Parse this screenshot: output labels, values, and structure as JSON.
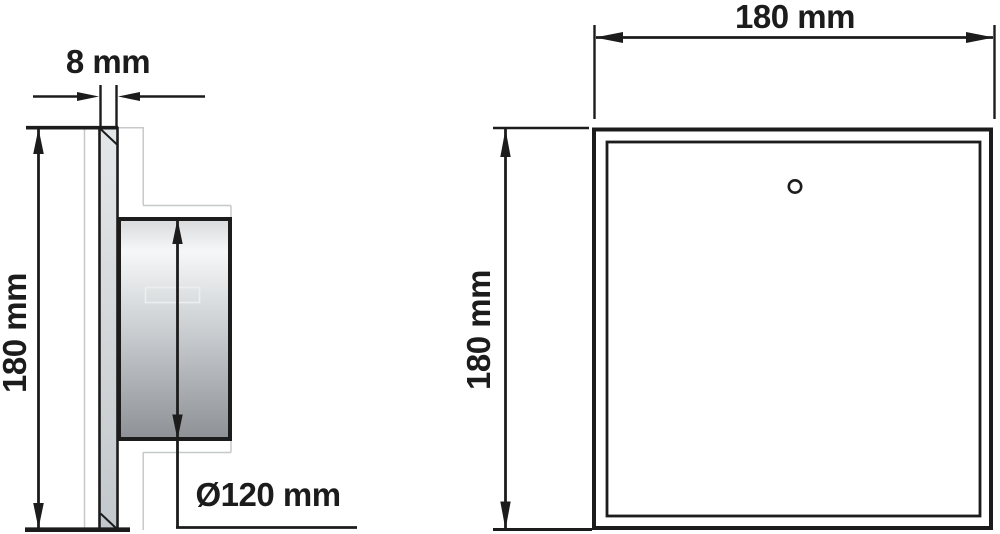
{
  "labels": {
    "side_view": {
      "thickness": "8 mm",
      "height": "180 mm",
      "diameter": "Ø120 mm"
    },
    "front_view": {
      "width": "180 mm",
      "height": "180 mm"
    }
  },
  "colors": {
    "line": "#1c1c1c",
    "faint_line": "#c6c9cb",
    "background": "#ffffff",
    "plate_fill_top": "#e4e7e9",
    "plate_fill_bottom": "#c3c8cc",
    "cylinder_fill_top": "#d9dbdd",
    "cylinder_fill_highlight": "#f6f7f8",
    "cylinder_fill_mid": "#cdd1d4",
    "cylinder_fill_bottom": "#8e9296",
    "label_rect_line": "#eceeef"
  }
}
